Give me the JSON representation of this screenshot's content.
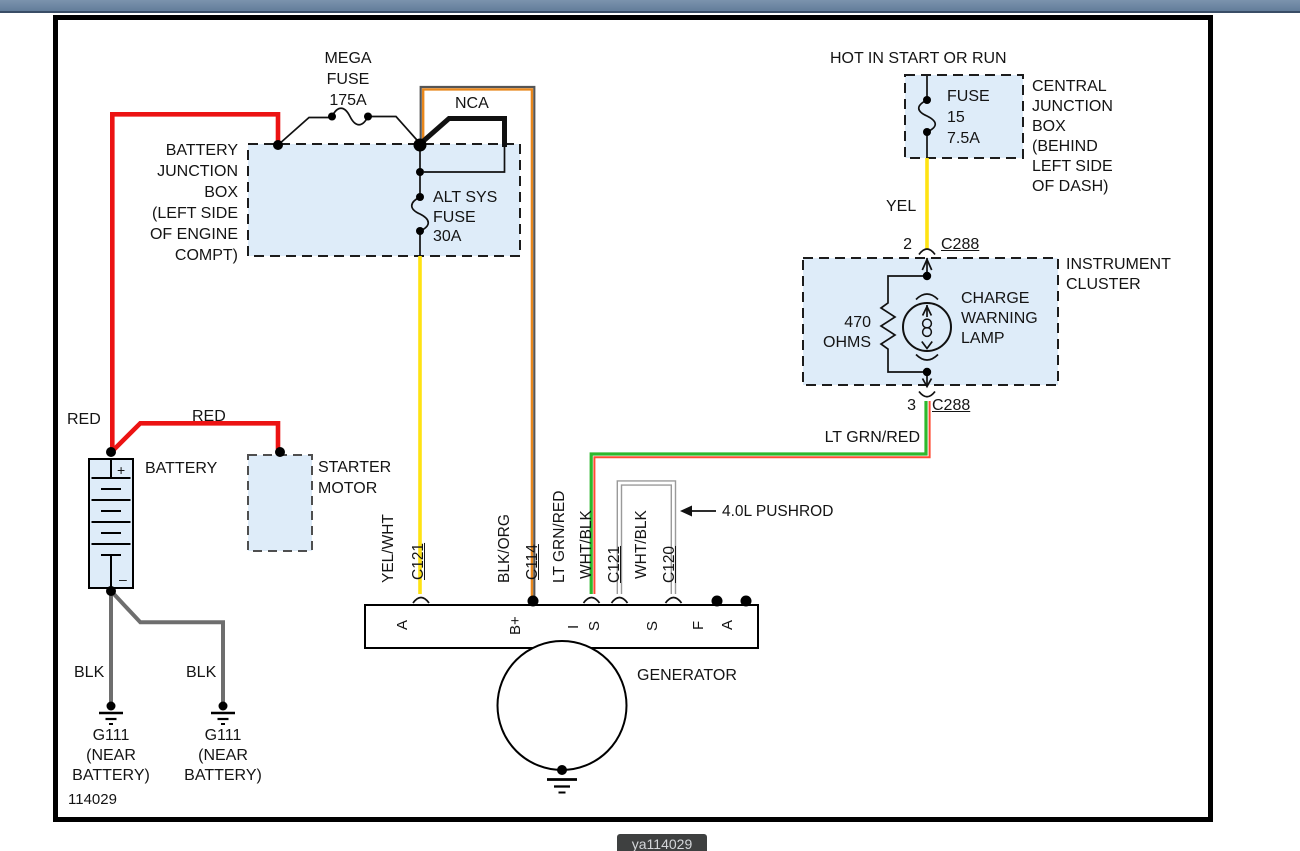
{
  "colors": {
    "topbar": "#68829e",
    "topbar_edge": "#394d66",
    "box_fill": "#deecf9",
    "frame": "#000000",
    "wire_red": "#ec1313",
    "wire_yellow": "#ffe312",
    "wire_orange": "#e8871c",
    "wire_green": "#2db92d",
    "wire_green_trace": "#ff4a33",
    "wire_gray": "#6e6e6e",
    "wire_white": "#ffffff",
    "badge_bg": "#3e4040",
    "badge_text": "#d4d7da"
  },
  "page": {
    "sheet_number": "114029",
    "badge": "ya114029"
  },
  "battery_junction_box": {
    "label": [
      "BATTERY",
      "JUNCTION",
      "BOX",
      "(LEFT SIDE",
      "OF ENGINE",
      "COMPT)"
    ],
    "mega_fuse": [
      "MEGA",
      "FUSE",
      "175A"
    ],
    "nca": "NCA",
    "alt_fuse": [
      "ALT SYS",
      "FUSE",
      "30A"
    ]
  },
  "central_junction_box": {
    "hot": "HOT IN START OR RUN",
    "fuse": [
      "FUSE",
      "15",
      "7.5A"
    ],
    "label": [
      "CENTRAL",
      "JUNCTION",
      "BOX",
      "(BEHIND",
      "LEFT SIDE",
      "OF DASH)"
    ],
    "wire": "YEL",
    "pin": "2",
    "connector": "C288"
  },
  "instrument_cluster": {
    "label": [
      "INSTRUMENT",
      "CLUSTER"
    ],
    "resistor": [
      "470",
      "OHMS"
    ],
    "lamp": [
      "CHARGE",
      "WARNING",
      "LAMP"
    ],
    "pin": "3",
    "connector": "C288",
    "wire": "LT GRN/RED"
  },
  "battery_area": {
    "battery": "BATTERY",
    "plus": "+",
    "minus": "–",
    "red_left": "RED",
    "red_top": "RED",
    "starter": [
      "STARTER",
      "MOTOR"
    ],
    "blk_1": "BLK",
    "blk_2": "BLK",
    "ground_1": [
      "G111",
      "(NEAR",
      "BATTERY)"
    ],
    "ground_2": [
      "G111",
      "(NEAR",
      "BATTERY)"
    ]
  },
  "generator": {
    "label": "GENERATOR",
    "terminals": [
      "A",
      "B+",
      "I",
      "S",
      "S",
      "F",
      "A"
    ],
    "wire_labels": [
      "YEL/WHT",
      "C121",
      "BLK/ORG",
      "C114",
      "LT GRN/RED",
      "WHT/BLK",
      "C121",
      "WHT/BLK",
      "C120"
    ],
    "pushrod": "4.0L PUSHROD"
  }
}
